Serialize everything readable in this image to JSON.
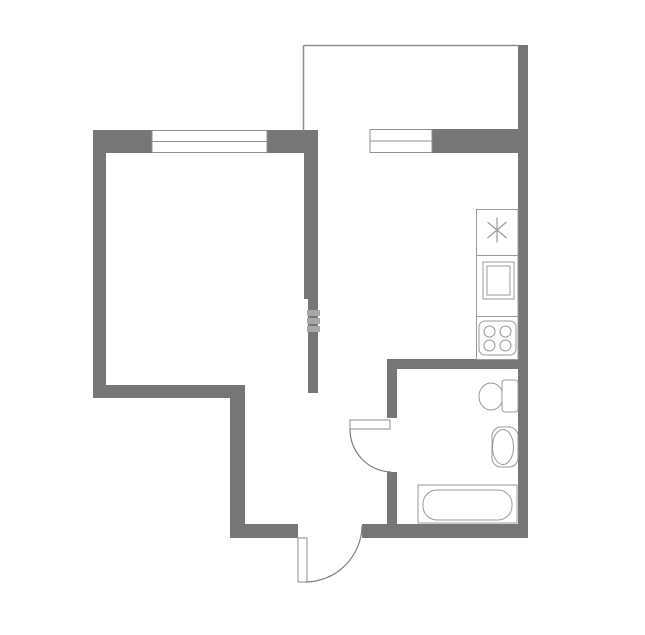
{
  "canvas": {
    "width": 645,
    "height": 635,
    "background": "#ffffff"
  },
  "palette": {
    "wall": "#767676",
    "opening_line": "#8f8f8f",
    "fixture_line": "#9a9a9a",
    "arc_line": "#7f7f7f",
    "watermark": "#a8a8a8",
    "white": "#ffffff"
  },
  "floor_plan": {
    "walls": [
      {
        "name": "wall-top-left-segment",
        "type": "rect",
        "x": 93,
        "y": 130,
        "w": 59,
        "h": 23,
        "fill": "$wall"
      },
      {
        "name": "wall-top-middle-segment",
        "type": "rect",
        "x": 267,
        "y": 130,
        "w": 51,
        "h": 23,
        "fill": "$wall"
      },
      {
        "name": "wall-left-exterior",
        "type": "rect",
        "x": 93,
        "y": 130,
        "w": 13,
        "h": 268,
        "fill": "$wall"
      },
      {
        "name": "wall-room-bottom",
        "type": "rect",
        "x": 93,
        "y": 385,
        "w": 152,
        "h": 13,
        "fill": "$wall"
      },
      {
        "name": "wall-corridor-left",
        "type": "rect",
        "x": 230,
        "y": 385,
        "w": 15,
        "h": 153,
        "fill": "$wall"
      },
      {
        "name": "wall-bottom-left-segment",
        "type": "rect",
        "x": 230,
        "y": 524,
        "w": 68,
        "h": 14,
        "fill": "$wall"
      },
      {
        "name": "wall-bottom-right-segment",
        "type": "rect",
        "x": 362,
        "y": 524,
        "w": 166,
        "h": 14,
        "fill": "$wall"
      },
      {
        "name": "wall-middle-upper",
        "type": "rect",
        "x": 304,
        "y": 153,
        "w": 14,
        "h": 146,
        "fill": "$wall"
      },
      {
        "name": "wall-middle-lower",
        "type": "rect",
        "x": 308,
        "y": 299,
        "w": 10,
        "h": 94,
        "fill": "$wall"
      },
      {
        "name": "wall-kitchen-top-segment",
        "type": "rect",
        "x": 432,
        "y": 129,
        "w": 87,
        "h": 24,
        "fill": "$wall"
      },
      {
        "name": "wall-right-exterior",
        "type": "rect",
        "x": 518,
        "y": 45,
        "w": 10,
        "h": 493,
        "fill": "$wall"
      },
      {
        "name": "wall-bath-kitchen-divider",
        "type": "rect",
        "x": 387,
        "y": 359,
        "w": 131,
        "h": 10,
        "fill": "$wall"
      },
      {
        "name": "wall-bath-left-upper",
        "type": "rect",
        "x": 387,
        "y": 359,
        "w": 10,
        "h": 59,
        "fill": "$wall"
      },
      {
        "name": "wall-bath-left-lower",
        "type": "rect",
        "x": 387,
        "y": 472,
        "w": 10,
        "h": 52,
        "fill": "$wall"
      }
    ],
    "balcony": [
      {
        "name": "balcony-left-line",
        "type": "line",
        "x1": 303.5,
        "y1": 45.5,
        "x2": 303.5,
        "y2": 131,
        "stroke": "$opening_line",
        "sw": 1.5
      },
      {
        "name": "balcony-top-line",
        "type": "line",
        "x1": 303.5,
        "y1": 45.5,
        "x2": 519,
        "y2": 45.5,
        "stroke": "$opening_line",
        "sw": 1.5
      }
    ],
    "windows": [
      {
        "name": "room-window-frame",
        "type": "rect",
        "x": 152,
        "y": 130.5,
        "w": 115,
        "h": 22,
        "fill": "$white",
        "stroke": "$opening_line",
        "sw": 1
      },
      {
        "name": "room-window-midline",
        "type": "line",
        "x1": 152,
        "y1": 141.5,
        "x2": 267,
        "y2": 141.5,
        "stroke": "$opening_line",
        "sw": 1
      },
      {
        "name": "kitchen-window-frame",
        "type": "rect",
        "x": 370,
        "y": 129.5,
        "w": 62,
        "h": 23,
        "fill": "$white",
        "stroke": "$opening_line",
        "sw": 1
      },
      {
        "name": "kitchen-window-midline",
        "type": "line",
        "x1": 370,
        "y1": 141,
        "x2": 432,
        "y2": 141,
        "stroke": "$opening_line",
        "sw": 1
      }
    ],
    "kitchen_unit": [
      {
        "name": "kitchen-counter-outline",
        "type": "rect",
        "x": 476.5,
        "y": 209.5,
        "w": 41.5,
        "h": 150,
        "fill": "none",
        "stroke": "$fixture_line",
        "sw": 1
      },
      {
        "name": "counter-divider-top",
        "type": "line",
        "x1": 476.5,
        "y1": 255.5,
        "x2": 518,
        "y2": 255.5,
        "stroke": "$fixture_line",
        "sw": 1
      },
      {
        "name": "counter-divider-bottom",
        "type": "line",
        "x1": 476.5,
        "y1": 316.5,
        "x2": 518,
        "y2": 316.5,
        "stroke": "$fixture_line",
        "sw": 1
      },
      {
        "name": "sink-asterisk-icon-vertical",
        "type": "line",
        "x1": 497,
        "y1": 217.5,
        "x2": 497,
        "y2": 242.5,
        "stroke": "$fixture_line",
        "sw": 1.2
      },
      {
        "name": "sink-asterisk-icon-diag1",
        "type": "line",
        "x1": 487.5,
        "y1": 222,
        "x2": 506.5,
        "y2": 238,
        "stroke": "$fixture_line",
        "sw": 1.2
      },
      {
        "name": "sink-asterisk-icon-diag2",
        "type": "line",
        "x1": 487.5,
        "y1": 238,
        "x2": 506.5,
        "y2": 222,
        "stroke": "$fixture_line",
        "sw": 1.2
      },
      {
        "name": "appliance-outer-box",
        "type": "rect",
        "x": 483,
        "y": 262,
        "w": 31,
        "h": 37,
        "fill": "none",
        "stroke": "$fixture_line",
        "sw": 1
      },
      {
        "name": "appliance-inner-box",
        "type": "rect",
        "x": 487,
        "y": 266,
        "w": 23,
        "h": 29,
        "fill": "none",
        "stroke": "$fixture_line",
        "sw": 1
      },
      {
        "name": "stove-outline",
        "type": "rect",
        "x": 479,
        "y": 321,
        "w": 37,
        "h": 34,
        "rx": 6,
        "fill": "none",
        "stroke": "$fixture_line",
        "sw": 1
      },
      {
        "name": "stove-burner-top-left",
        "type": "circle",
        "cx": 489.5,
        "cy": 331.5,
        "r": 5.5,
        "fill": "none",
        "stroke": "$fixture_line",
        "sw": 1
      },
      {
        "name": "stove-burner-top-right",
        "type": "circle",
        "cx": 505.5,
        "cy": 331.5,
        "r": 5.5,
        "fill": "none",
        "stroke": "$fixture_line",
        "sw": 1
      },
      {
        "name": "stove-burner-bottom-left",
        "type": "circle",
        "cx": 489.5,
        "cy": 345.5,
        "r": 5.5,
        "fill": "none",
        "stroke": "$fixture_line",
        "sw": 1
      },
      {
        "name": "stove-burner-bottom-right",
        "type": "circle",
        "cx": 505.5,
        "cy": 345.5,
        "r": 5.5,
        "fill": "none",
        "stroke": "$fixture_line",
        "sw": 1
      }
    ],
    "bathroom_fixtures": [
      {
        "name": "toilet-bowl",
        "type": "ellipse",
        "cx": 491,
        "cy": 396.5,
        "rx": 12,
        "ry": 13.5,
        "fill": "$white",
        "stroke": "$fixture_line",
        "sw": 1
      },
      {
        "name": "toilet-tank",
        "type": "rect",
        "x": 502,
        "y": 380,
        "w": 16,
        "h": 32,
        "rx": 3,
        "fill": "$white",
        "stroke": "$fixture_line",
        "sw": 1
      },
      {
        "name": "sink-counter",
        "type": "rect",
        "x": 492,
        "y": 427,
        "w": 26,
        "h": 40,
        "rx": 9,
        "fill": "$white",
        "stroke": "$fixture_line",
        "sw": 1
      },
      {
        "name": "sink-basin",
        "type": "ellipse",
        "cx": 503,
        "cy": 447,
        "rx": 10.5,
        "ry": 17.5,
        "fill": "none",
        "stroke": "$fixture_line",
        "sw": 1
      },
      {
        "name": "bathtub-outer",
        "type": "rect",
        "x": 418,
        "y": 485,
        "w": 99,
        "h": 38,
        "fill": "$white",
        "stroke": "$fixture_line",
        "sw": 1
      },
      {
        "name": "bathtub-inner",
        "type": "rect",
        "x": 423,
        "y": 490,
        "w": 89,
        "h": 30,
        "rx": 14,
        "fill": "none",
        "stroke": "$fixture_line",
        "sw": 1
      }
    ],
    "doors": [
      {
        "name": "bathroom-door-leaf",
        "type": "rect",
        "x": 350,
        "y": 420,
        "w": 40,
        "h": 9,
        "fill": "$white",
        "stroke": "$opening_line",
        "sw": 1
      },
      {
        "name": "bathroom-door-arc",
        "type": "path",
        "d": "M 350 429 A 42.5 42.5 0 0 0 391 472",
        "fill": "none",
        "stroke": "$arc_line",
        "sw": 1.2
      },
      {
        "name": "entry-door-leaf",
        "type": "rect",
        "x": 298,
        "y": 538,
        "w": 9,
        "h": 44,
        "fill": "$white",
        "stroke": "$opening_line",
        "sw": 1
      },
      {
        "name": "entry-door-arc",
        "type": "path",
        "d": "M 305 582 A 57 57 0 0 0 362 526",
        "fill": "none",
        "stroke": "$arc_line",
        "sw": 1.2
      }
    ],
    "watermark_marks": [
      {
        "name": "watermark-tick-1",
        "type": "rect",
        "x": 307,
        "y": 310,
        "w": 13,
        "h": 6,
        "fill": "$watermark"
      },
      {
        "name": "watermark-tick-2",
        "type": "rect",
        "x": 307,
        "y": 318,
        "w": 13,
        "h": 6,
        "fill": "$watermark"
      },
      {
        "name": "watermark-tick-3",
        "type": "rect",
        "x": 307,
        "y": 326,
        "w": 13,
        "h": 6,
        "fill": "$watermark"
      }
    ]
  }
}
